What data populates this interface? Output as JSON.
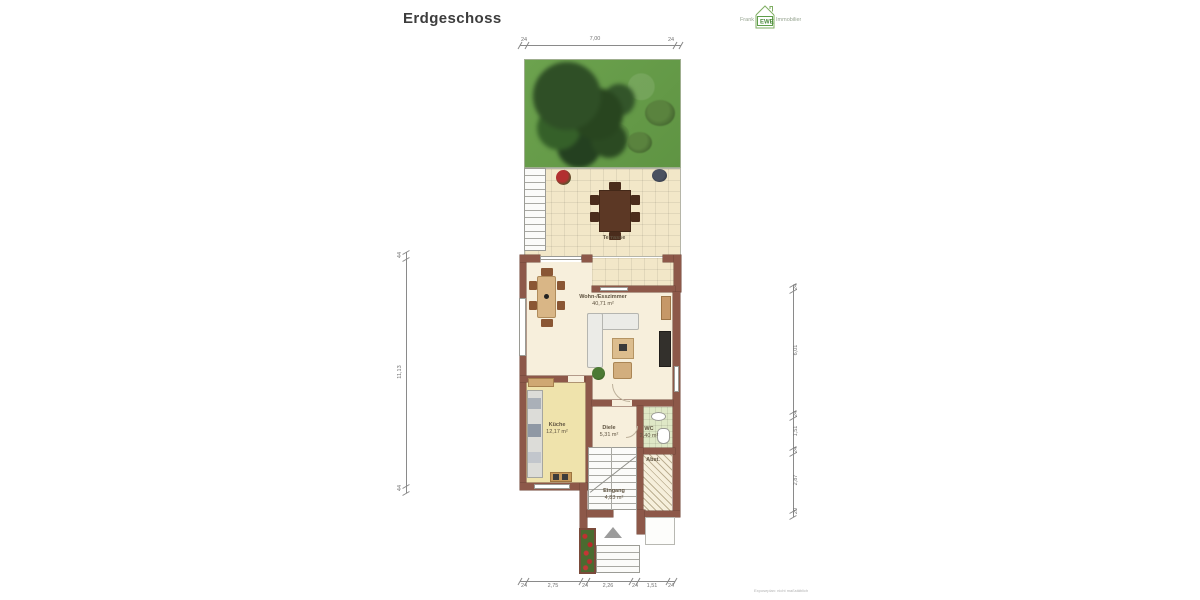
{
  "page": {
    "title": "Erdgeschoss",
    "disclaimer": "Exposeplan: nicht maßstäblich"
  },
  "logo": {
    "left": "Frank",
    "center": "EWE",
    "right": "Immobilien"
  },
  "rooms": {
    "terrasse": {
      "label": "Terrasse"
    },
    "wohnen": {
      "label": "Wohn-/Esszimmer",
      "area": "40,71 m²"
    },
    "kueche": {
      "label": "Küche",
      "area": "12,17 m²"
    },
    "diele": {
      "label": "Diele",
      "area": "5,31 m²"
    },
    "wc": {
      "label": "WC",
      "area": "2,40 m²"
    },
    "abst": {
      "label": "Abst."
    },
    "eingang": {
      "label": "Eingang",
      "area": "4,83 m²"
    }
  },
  "dimensions": {
    "top": [
      "24",
      "7,00",
      "24"
    ],
    "bottom": [
      "24",
      "2,75",
      "24",
      "2,26",
      "24",
      "1,51",
      "24"
    ],
    "left": [
      "44",
      "11,13",
      "44"
    ],
    "right": [
      "24",
      "6,01",
      "24",
      "1,51",
      "24",
      "2,87",
      "20"
    ]
  },
  "colors": {
    "wall": "#8d5849",
    "floor": "#f7efdc",
    "kitchen": "#efe3ac",
    "wc": "#dfe8c6",
    "tile": "#f2e7c8",
    "grass": "#67a04a",
    "accent": "#5e9e4a",
    "dim": "#8a8a8a"
  }
}
